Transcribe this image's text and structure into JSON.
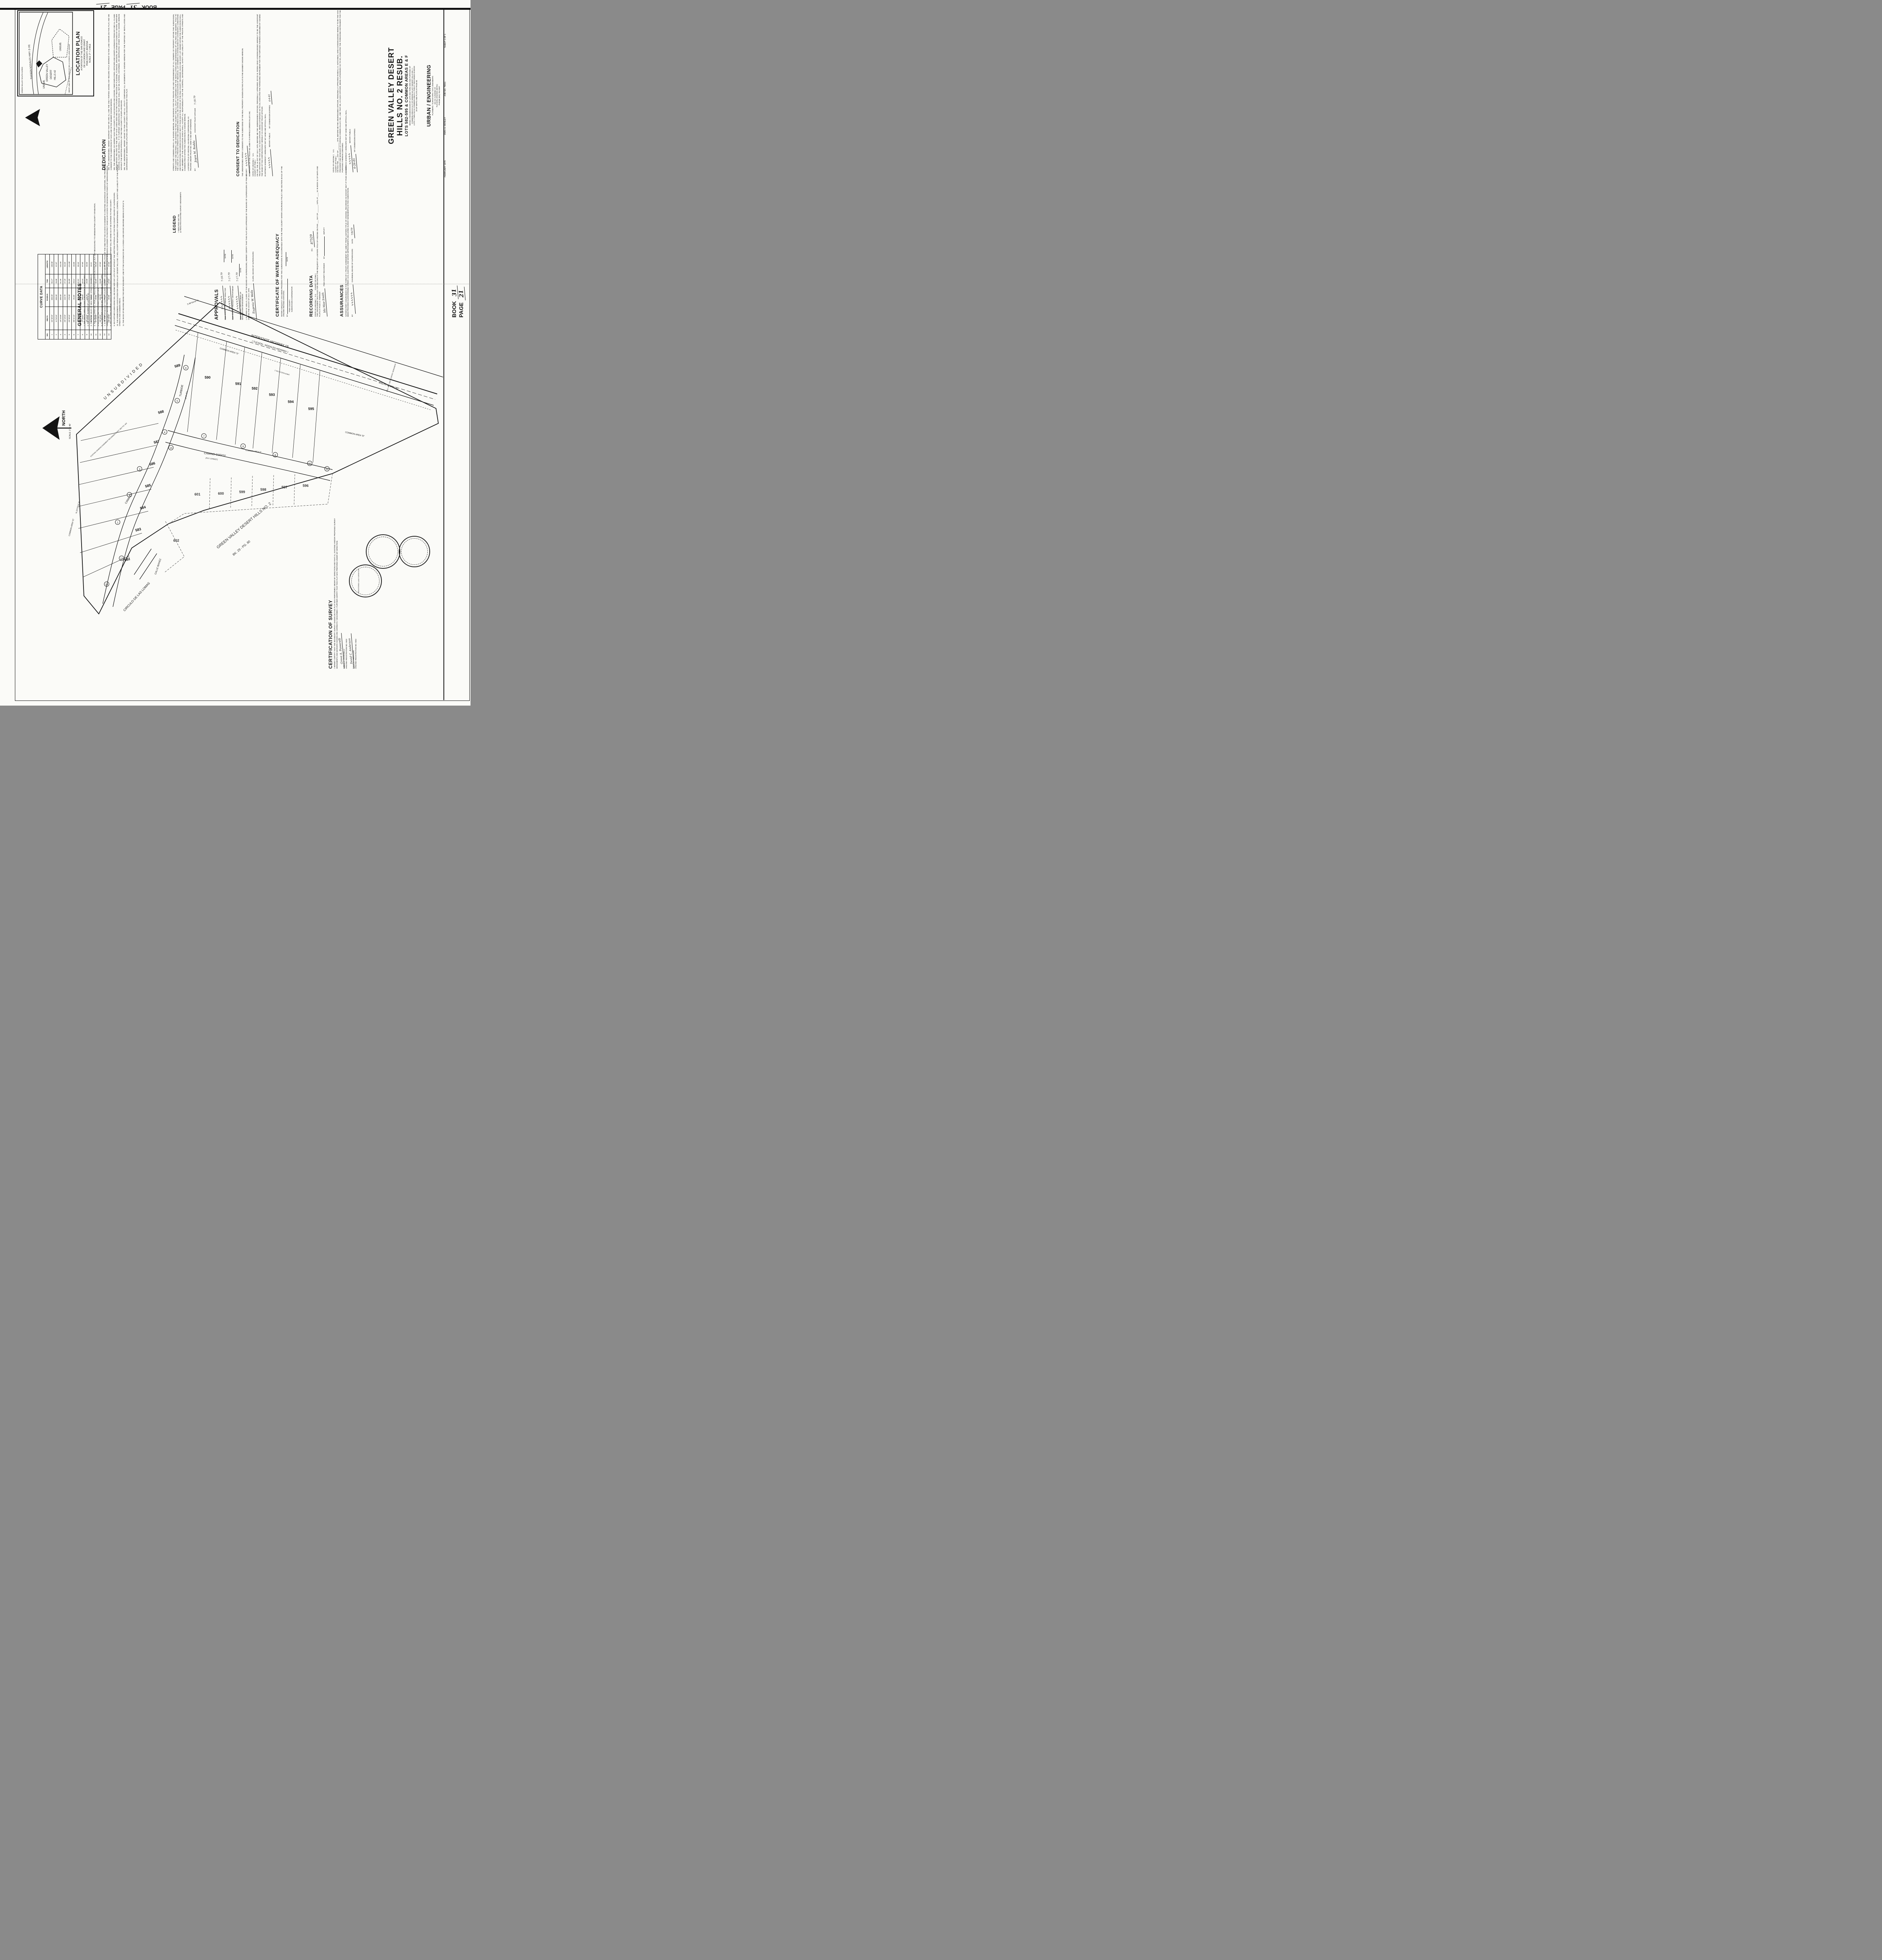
{
  "stamp_top": {
    "book_label": "BOOK",
    "book": "31",
    "page_label": "PAGE",
    "page": "21"
  },
  "location_plan": {
    "title": "LOCATION PLAN",
    "caption1": "A PORTION OF THE SAN IGNACIO",
    "caption2": "DE LA CANOA LAND GRANT",
    "caption3": "PIMA COUNTY, ARIZONA",
    "caption4": "SCALE: 2\" = 1 MILE",
    "highway": "TUCSON NOGALES HWY. (I-19)",
    "subject1": "GREEN VALLEY",
    "subject2": "DESERT",
    "subject3": "HILLS #2",
    "unsub1": "UNSUB.",
    "unsub2": "UNSUB.",
    "side_label": "GREEN VALLEY SOUTH ACRES",
    "grant_line": "WEST LINE OF SAN IGNACIO DE LA CANOA LAND GRANT",
    "north": "NORTH"
  },
  "dedication": {
    "heading": "DEDICATION",
    "p1": "WE, THE UNDERSIGNED, HEREBY WARRANT THAT WE ARE ALL AND THE ONLY PARTIES HAVING ANY RECORD TITLE INTEREST IN THE LAND SHOWN ON THIS PLAT, AND WE CONSENT TO THE SUBDIVISION OF SAID LAND IN THE MANNER SHOWN HEREON.",
    "p2": "WE, THE UNDERSIGNED, DO HEREBY SAVE PIMA COUNTY, ITS SUCCESSORS AND ASSIGNS, THEIR EMPLOYEES, OFFICERS AND AGENTS HARMLESS FROM ANY AND ALL CLAIMS FOR DAMAGES RELATED TO THE USE OF SAID LANDS NOW AND IN THE FUTURE BY REASON OF FLOODING, FLOWAGE, EROSION, OR DAMAGE CAUSED BY WATER, WHETHER SURFACE, FLOOD OR RAINFALL. IT IS FURTHER UNDERSTOOD THAT DRAINAGE SHALL NOT BE ALTERED, DISTURBED, OR OBSTRUCTED OTHER THAN AS SHOWN HEREON WITHOUT THE WRITTEN APPROVAL OF THE PIMA COUNTY FLOODPLAIN BOARD.",
    "p3": "WE, THE UNDERSIGNED, HEREBY GRANT TO PIMA COUNTY AND ALL UTILITY COMPANIES ALL EASEMENTS AS SHOWN HEREON FOR THE PURPOSE OF INSTALLATION AND MAINTENANCE OF SEWERS AND UTILITIES AND OTHER USES AS DESIGNATED BY THIS PLAT."
  },
  "streets_common": {
    "text": "STREETS AND COMMON AREAS, AS SHOWN HEREON, ARE RESERVED FOR THE PRIVATE USE AND CONVENIENCE OF ALL OWNERS OF PROPERTY WITHIN THIS SUBDIVISION, THEIR GUEST AND INVITEES, AND GRANTED TO PIMA COUNTY AND ALL UTILITY COMPANIES FOR THE INSTALLATION AND MAINTENANCE OF UTILITIES AND SEWERS. TITLE TO THE LAND OF ALL PRIVATE STREETS AND COMMON AREAS SHALL BE VESTED IN AN ASSOCIATION OF INDIVIDUAL LOT OWNERS AS ESTABLISHED BY COVENANTS, CONDITIONS AND RESTRICTIONS RECORDED IN DOCKET 5827 AT PAGE 626 IN THE OFFICE OF THE PIMA COUNTY RECORDER. EACH AND EVERY LOT OWNER WITHIN THE SUBDIVISION SHALL BE A MEMBER OF THE ASSOCIATION WHICH SHALL ACCEPT ALL RESPONSIBILITY FOR THE CONTROL, MAINTENANCE, SAFETY AND LIABILITY OF THE PRIVATE STREETS AND COMMON AREAS WITHIN THIS SUBDIVISION AS SHOWN HEREON.",
    "trustee1": "LAWYERS TITLE OF ARIZONA, AN ARIZONA CORPORATION, AS",
    "trustee2": "TRUSTEE UNDER TRUST NO. 6486-T, AND NOT OTHERWISE.",
    "by_label": "BY:",
    "signature": "Joyce M. Rodda",
    "signer_title": "ASSISTANT TRUST OFFICER",
    "date": "7-18-79"
  },
  "consent": {
    "heading": "CONSENT TO DEDICATION",
    "body": "THE UNDERSIGNED HEREBY CONSENTS TO THE SUBDIVIDING OF THE REAL PROPERTY SHOWN ON THIS PLAT IN THE MANNER SHOWN HEREON.",
    "beneficiary": "BENEFICIARY OF THE TRUST NO. 6486-T IS FAIRFIELD GREEN VALLEY, INC.",
    "by_label": "BY",
    "signature": "∿∿∿∿∿∿"
  },
  "ack1": {
    "state": "STATE OF ARIZONA )",
    "ss": "S.S.",
    "county": "COUNTY OF PIMA )",
    "body": "ON THIS THE 16 DAY OF JULY, 1979, BEFORE ME THE UNDERSIGNED OFFICER, PERSONALLY APPEARED JOYCE M. RODDA WHO ACKNOWLEDGED HERSELF TO BE THE ASSISTANT TRUST OFFICER AND THAT SHE, AS SUCH OFFICER, BEING AUTHORIZED SO TO DO, EXECUTED THE FOREGOING INSTRUMENT FOR THE PURPOSES THEREIN CONTAINED BY SIGNING THE NAME OF THE CORPORATION BY HERSELF AS ASSISTANT TRUST OFFICER.",
    "witness": "IN WITNESS WHEREOF I HEREUNTO SET MY HAND AND OFFICIAL SEAL.",
    "notary_sig": "∿∿∿∿∿",
    "notary_label": "NOTARY PUBLIC",
    "expires_label": "MY COMMISSION EXPIRES",
    "expires": "6-6-81"
  },
  "ack2": {
    "state": "STATE OF ARIZONA )",
    "ss": "S.S.",
    "county": "COUNTY OF PIMA )",
    "body": "ON THIS THE ___ DAY OF _______, 1979, BEFORE ME THE UNDERSIGNED OFFICER, PERSONALLY APPEARED RANDALL E. HUTCHINGS, WHO ACKNOWLEDGED HIMSELF TO BE THE VICE PRESIDENT AND MANAGER OF FAIRFIELD GREEN VALLEY, INC., AND THAT HE, AS SUCH OFFICER, BEING AUTHORIZED SO TO DO, EXECUTED THE FOREGOING INSTRUMENT FOR THE PURPOSES THEREIN CONTAINED.",
    "witness": "IN WITNESS WHEREOF I HEREUNTO SET MY HAND AND OFFICIAL SEAL.",
    "notary_sig": "∿∿∿∿∿",
    "notary_label": "NOTARY PUBLIC",
    "expires_label": "MY COMMISSION EXPIRES",
    "expires": "6-26-81"
  },
  "general_notes": {
    "heading": "GENERAL NOTES",
    "items": [
      "1. THE GROSS AREA OF THIS SUBDIVISION IS 9.709 ACRES.",
      "2. THE TOTAL NUMBER OF LOTS IS 14.",
      "3. THE TOTAL MILES OF NEW PUBLIC STREETS IS 0.0 MILES.",
      "4. THE DEVELOPER WILL PAVE ALL PRIVATE ROADS SHOWN ON THIS PLAT, BUT NOT NECESSARILY TO MINIMUM PIMA COUNTY STANDARDS.",
      "5. EXISTING AND PROPOSED ZONING: CR-5.",
      "6. ALL WEATHER ACCESS WILL BE PROVIDED TO ALL LOTS.",
      "7. IF, IN THE OPINION OF THE PIMA COUNTY HIGHWAY DEPARTMENT, VIOLATION OF THE ONE-FOOT NO ACCESS EASEMENT IS CREATING HAZARDOUS CONDITIONS, THE PROPERTY OWNER SHALL INSTALL PHYSICAL BARRIERS OR MODIFY EXISTING PHYSICAL BARRIERS IN ORDER TO RESTRICT VEHICULAR ACCESS TO DESIGNATED POINTS OF INGRESS/EGRESS.",
      "8. ANY UTILITIES THAT MAY HAVE TO BE RELOCATED AS A RESULT OF THIS DEVELOPMENT WILL BE DONE SO AT NO EXPENSE TO PIMA COUNTY.",
      "9. NO FURTHER SUBDIVIDING WILL BE DONE NOR ANY LOTS SPLIT WITHOUT THE WRITTEN APPROVAL OF THE PIMA COUNTY BOARD OF SUPERVISORS.",
      "10. THE HOMEOWNERS ASSOCIATION FOR GREEN VALLEY DESERT HILLS NO. 2 WILL ACCEPT RESPONSIBILITY FOR MAINTENANCE, CONTROL, SAFETY AND LIABILITY OF THE PRIVATE STREETS AND COMMON AREAS.",
      "11. THE BASIS OF BEARING BEING THE WEST BOUNDARY LINE OF THE SAN IGNACIO DE LA CANOA LAND GRANT, BEARING BEING N 23°03'14\" E."
    ]
  },
  "legend": {
    "heading": "LEGEND",
    "item1_sym": "○",
    "item1": "INDICATES SET PIN",
    "item2_sym": "▲",
    "item2": "INDICATES EXISTING SURVEY MONUMENTS"
  },
  "approvals": {
    "heading": "APPROVALS",
    "sig1": "∿∿∿∿∿∿",
    "title1": "PIMA COUNTY PLANNING DIRECTOR",
    "date1": "7-18-79",
    "sig2": "∿∿∿∿∿∿",
    "title2": "PIMA COUNTY HIGHWAY DEPARTMENT",
    "date2": "7-17-79",
    "sig3": "∿∿∿∿∿∿",
    "title3a": "PIMA COUNTY DEPARTMENT OF",
    "title3b": "WASTEWATER MANAGEMENT",
    "date3": "7-17-79",
    "clerk_text": "I, EUGENIA W. WELLS, CLERK OF THE BOARD OF SUPERVISORS, HEREBY CERTIFY THAT THIS PLAT WAS APPROVED BY THE BOARD OF SUPERVISORS OF PIMA COUNTY ON THIS THE 2nd DAY OF JULY, 1979.",
    "clerk_sig": "Eugenia W. Wells",
    "clerk_label": "CLERK, BOARD OF SUPERVISORS",
    "date_label": "DATE"
  },
  "water": {
    "heading": "CERTIFICATE OF WATER ADEQUACY",
    "body": "WATER ADEQUACY HAS BEEN PROVIDED FOR THIS SUBDIVISION IN ACCORDANCE WITH THE PIMA COUNTY WATER ASSURANCE POLICY AND SECTION 45-515 OF THE ARIZONA REVISED STATUTES.",
    "by_label": "BY",
    "signer1": "PIMA COUNTY",
    "signer2": "SUBDIVISION COORDINATOR",
    "date_label": "DATE"
  },
  "recording": {
    "heading": "RECORDING DATA",
    "state": "STATE OF ARIZONA )",
    "ss": "S.S.",
    "county": "COUNTY OF PIMA )",
    "no_label": "No.",
    "no": "87529",
    "body": "THIS INSTRUMENT WAS FILED FOR RECORD AT THE REQUEST OF LAWYERS TITLE OF ARIZONA ON THIS ___ DAY OF _______, 1979, AT ____ M. IN BOOK 31 OF MAPS AND PLATS AT PAGE 21 THEREOF.",
    "recorder_sig": "Ida Mae Smith",
    "recorder_label": "PIMA COUNTY RECORDER",
    "by_label": "BY",
    "deputy_label": "DEPUTY"
  },
  "assurances": {
    "heading": "ASSURANCES",
    "body": "SATISFACTORY ASSURANCES IN THE FORM OF A TRUST AGREEMENT NO. 6486-T FROM LAWYERS TITLE OF ARIZONA, RECORDED IN DOCKET 5827 AT PAGE 642, HAVE BEEN PROVIDED GUARANTEEING STREET, GAS, ELECTRIC AND WATER IMPROVEMENTS (INCLUDING SURVEY MONUMENTS) IN THIS SUBDIVISION.",
    "by_label": "BY",
    "sig": "∿∿∿∿∿∿",
    "chairman_label": "CHAIRMAN, BOARD OF SUPERVISORS",
    "date_label": "DATE",
    "date": "7/9/79"
  },
  "cert_survey": {
    "heading": "CERTIFICATION OF SURVEY",
    "body": "I HEREBY CERTIFY THAT THE BOUNDARY SURVEY SHOWN ON THIS PLAT WAS PERFORMED UNDER MY DIRECTION AND THAT ALL EXISTING AND/OR PROPOSED SURVEY MONUMENTS AND MARKERS SHOWN ARE CORRECTLY DESCRIBED. I FURTHER CERTIFY THAT THIS PLAT WAS PREPARED UNDER MY DIRECTION.",
    "sig1": "Greve A. Passarelli",
    "signer1": "GREVE A. PASSARELLI",
    "reg1": "ARIZONA REGISTRATION NO. 9432",
    "sig2": "David C. Anderson",
    "signer2": "DAVID C. ANDERSON",
    "reg2": "ARIZONA REGISTRATION NO. 9452",
    "seal_text": "REGISTERED LAND SURVEYOR"
  },
  "title_block": {
    "title1": "GREEN VALLEY DESERT",
    "title2": "HILLS NO. 2 RESUB.",
    "title3": "LOTS 582-595 & COMMON AREAS E & F",
    "sub1": "BEING A RESUBDIVISION OF LOTS 582 THRU 595 AND PORTIONS OF",
    "sub2": "COMMON AREAS E & F OF GREEN VALLEY DESERT HILLS NO. 2 -",
    "sub3": "LOTS 1 THRU 613 & COMMON AREAS A THRU F RECORDED IN BOOK",
    "sub4": "29 OF MAPS AND PLATS AT PAGE 80.",
    "firm": "URBAN / ENGINEERING",
    "firm1": "PLANNERS / SURVEYORS / CIVIL ENGINEERS",
    "firm2": "201 W. CUSHING ST.",
    "firm3": "TUCSON, ARIZONA (85701)",
    "firm4": "PHONE (602) 792-0097"
  },
  "margin": {
    "date": "FEBRUARY 1979",
    "dwn": "DWN: H. MOSLEY",
    "job": "JOB NO. 79011",
    "sheet": "SHEET 1 OF 1",
    "book_label": "BOOK",
    "book": "31",
    "page_label": "PAGE",
    "page": "21"
  },
  "curve_table": {
    "title": "CURVE DATA",
    "headers": [
      "NO.",
      "DELTA",
      "RADIUS",
      "TAN",
      "LENGTH"
    ],
    "rows": [
      [
        "1",
        "34°30'25\"",
        "300.00'",
        "93.17'",
        "180.68'"
      ],
      [
        "2",
        "11°04'19\"",
        "300.00'",
        "29.08'",
        "57.97'"
      ],
      [
        "3",
        "19°23'39\"",
        "300.00'",
        "51.26'",
        "101.55'"
      ],
      [
        "4",
        "26°13'23\"",
        "116.75'",
        "27.19'",
        "53.43'"
      ],
      [
        "5",
        "25°49'15\"",
        "270.00'",
        "61.89'",
        "121.68'"
      ],
      [
        "6",
        "98°41'10\"",
        "25.00'",
        "29.11'",
        "43.06'"
      ],
      [
        "7",
        "13°02'21\"",
        "288.00'",
        "32.91'",
        "65.54'"
      ],
      [
        "8",
        "17°25'57\"",
        "288.00'",
        "44.14'",
        "87.60'"
      ],
      [
        "9",
        "26°13'23\"",
        "128.75'",
        "29.99'",
        "58.93'"
      ],
      [
        "10",
        "98°51'56\"",
        "20.00'",
        "23.36'",
        "34.51'"
      ],
      [
        "11",
        "57°43'00\"",
        "20.00'",
        "11.02'",
        "20.15'"
      ],
      [
        "12",
        "26°13'23\"",
        "104.75'",
        "24.40'",
        "47.94'"
      ],
      [
        "13",
        "10°54'59\"",
        "312.00'",
        "29.81'",
        "59.44'"
      ],
      [
        "14",
        "106°58'56\"",
        "20.00'",
        "27.02'",
        "37.34'"
      ]
    ]
  },
  "map": {
    "lots": [
      "582",
      "583",
      "584",
      "585",
      "586",
      "587",
      "588",
      "589",
      "590",
      "591",
      "592",
      "593",
      "594",
      "595"
    ],
    "context_lots": [
      "596",
      "597",
      "598",
      "599",
      "600",
      "601",
      "602"
    ],
    "street_turbide": "TURBIDE",
    "turbide_pvt": "(PVT. ST.)",
    "street_camino": "CAMINO",
    "street_godoy": "CAMINO GODOY",
    "godoy_pvt": "(PVT. STREET)",
    "common_f": "COMMON AREA \"F\"",
    "street_ibanez": "CALLE IBANEZ",
    "street_circulo": "CIRCULO DE LAS LOMAS",
    "hwy1": "INTERSTATE HIGHWAY 19",
    "hwy2": "( TUCSON - NOGALES HIGHWAY )",
    "common_e": "COMMON AREA \"E\"",
    "common_e2": "COMMON AREA \"E\"",
    "common_e3": "COMMON AREA \"E\"",
    "unsub": "UNSUBDIVIDED",
    "easement": "EXISTING GRADING EASEMENT RECORDED IN DKT. 5827 PG. 642",
    "context_name": "GREEN VALLEY DESERT HILLS NO. 2",
    "context_ref": "BK. 29 - PG. 80",
    "bearing_west": "N 23°03'14\" E",
    "bearing_top": "S 89°04'44\" E",
    "hwy_curve": "R=34747.48'   L=683.40'",
    "no_access": "1' NO ACCESS ESMT.",
    "monument": "ARIZ. HWY. DEPT. SURVEY MONUMENT",
    "north": "NORTH",
    "scale": "SCALE: 1\" = 40'",
    "curve_bubbles": [
      "1",
      "2",
      "3",
      "4",
      "5",
      "6",
      "7",
      "8",
      "9",
      "10",
      "11",
      "12",
      "13",
      "14"
    ]
  }
}
